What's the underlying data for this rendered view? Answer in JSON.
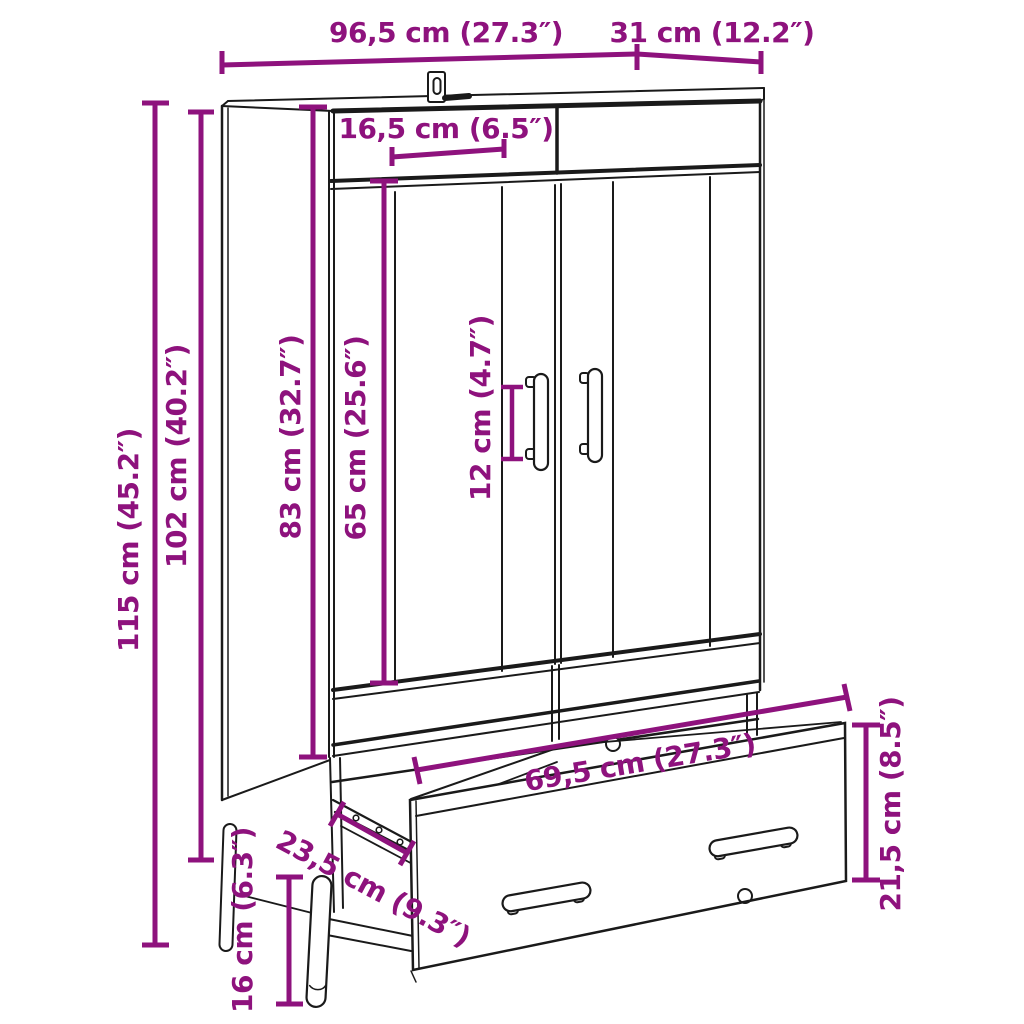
{
  "diagram": {
    "type": "furniture-dimension-diagram",
    "subject": "highboard cabinet with two doors and pulled-out bottom drawer, standing on legs",
    "colors": {
      "accent": "#8e127d",
      "line": "#1a1a1a",
      "background": "#ffffff"
    },
    "dimensions": [
      {
        "id": "width-total",
        "label": "96,5 cm (27.3″)"
      },
      {
        "id": "depth",
        "label": "31 cm (12.2″)"
      },
      {
        "id": "header-height",
        "label": "16,5 cm (6.5″)"
      },
      {
        "id": "height-total",
        "label": "115 cm (45.2″)"
      },
      {
        "id": "height-carcass",
        "label": "102 cm (40.2″)"
      },
      {
        "id": "door-outer",
        "label": "83 cm (32.7″)"
      },
      {
        "id": "door-inner",
        "label": "65 cm (25.6″)"
      },
      {
        "id": "handle-length",
        "label": "12 cm (4.7″)"
      },
      {
        "id": "drawer-width",
        "label": "69,5 cm (27.3″)"
      },
      {
        "id": "drawer-depth",
        "label": "23,5 cm (9.3″)"
      },
      {
        "id": "drawer-height",
        "label": "21,5 cm (8.5″)"
      },
      {
        "id": "leg-height",
        "label": "16 cm (6.3″)"
      }
    ]
  }
}
